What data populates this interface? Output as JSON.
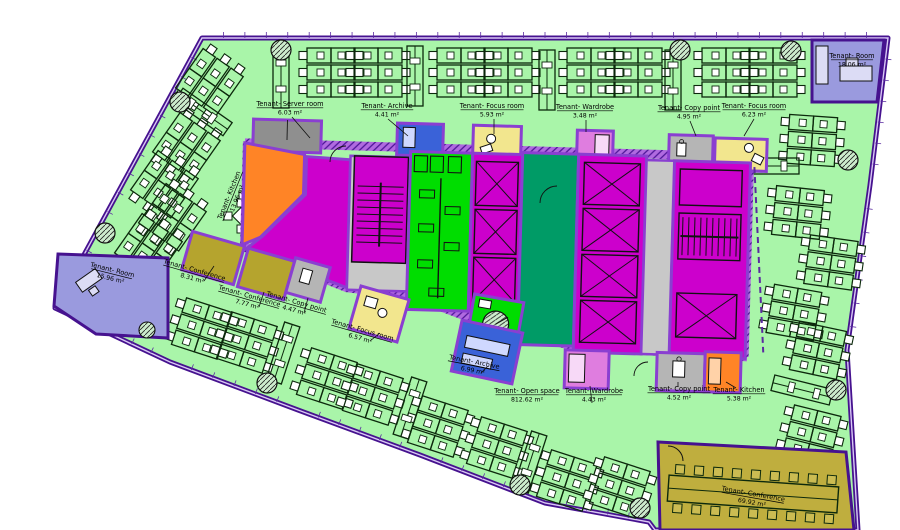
{
  "drawing": {
    "kind": "office-floor-plan",
    "tenant_prefix": "Tenant-",
    "area_unit": "m²"
  },
  "rooms": [
    {
      "id": "server-room",
      "label": "Tenant- Server room",
      "area": "6.03 m²"
    },
    {
      "id": "archive-top",
      "label": "Tenant- Archive",
      "area": "4.41 m²"
    },
    {
      "id": "focus-room-top",
      "label": "Tenant- Focus room",
      "area": "5.93 m²"
    },
    {
      "id": "wardrobe-top",
      "label": "Tenant- Wardrobe",
      "area": "3.48 m²"
    },
    {
      "id": "copy-point-top",
      "label": "Tenant- Copy point",
      "area": "4.95 m²"
    },
    {
      "id": "focus-room-topright",
      "label": "Tenant- Focus room",
      "area": "6.23 m²"
    },
    {
      "id": "room-topright",
      "label": "Tenant- Room",
      "area": "18.06 m²"
    },
    {
      "id": "kitchen-left",
      "label": "Tenant- Kitchen",
      "area": "13.96 m²"
    },
    {
      "id": "room-left",
      "label": "Tenant- Room",
      "area": "15.96 m²"
    },
    {
      "id": "conference-1",
      "label": "Tenant- Conference",
      "area": "8.31 m²"
    },
    {
      "id": "conference-2",
      "label": "Tenant- Conference",
      "area": "7.77 m²"
    },
    {
      "id": "copy-point-left",
      "label": "Tenant- Copy point",
      "area": "4.47 m²"
    },
    {
      "id": "focus-room-mid",
      "label": "Tenant- Focus room",
      "area": "6.57 m²"
    },
    {
      "id": "archive-mid",
      "label": "Tenant- Archive",
      "area": "6.99 m²"
    },
    {
      "id": "open-space",
      "label": "Tenant- Open space",
      "area": "812.62 m²"
    },
    {
      "id": "wardrobe-mid",
      "label": "Tenant- Wardrobe",
      "area": "4.43 m²"
    },
    {
      "id": "copy-point-bottom",
      "label": "Tenant- Copy point",
      "area": "4.52 m²"
    },
    {
      "id": "kitchen-bottom",
      "label": "Tenant- Kitchen",
      "area": "5.38 m²"
    },
    {
      "id": "conference-large",
      "label": "Tenant- Conference",
      "area": "69.92 m²"
    }
  ],
  "palette": {
    "open_space_green": "#a9f5a9",
    "wall_violet": "#8a3fd1",
    "outline_purple": "#46128f",
    "core_magenta": "#cc00cc",
    "wc_bright_green": "#00dd00",
    "shaft_dark_green": "#009b66",
    "archive_blue": "#3a62d8",
    "focus_yellow": "#f2e68e",
    "wardrobe_pink": "#df7ddf",
    "kitchen_orange": "#ff8426",
    "conference_olive": "#b5a42e",
    "room_periwinkle": "#9a9ade",
    "service_gray": "#b5b5b5",
    "server_gray": "#8f8f8f"
  }
}
